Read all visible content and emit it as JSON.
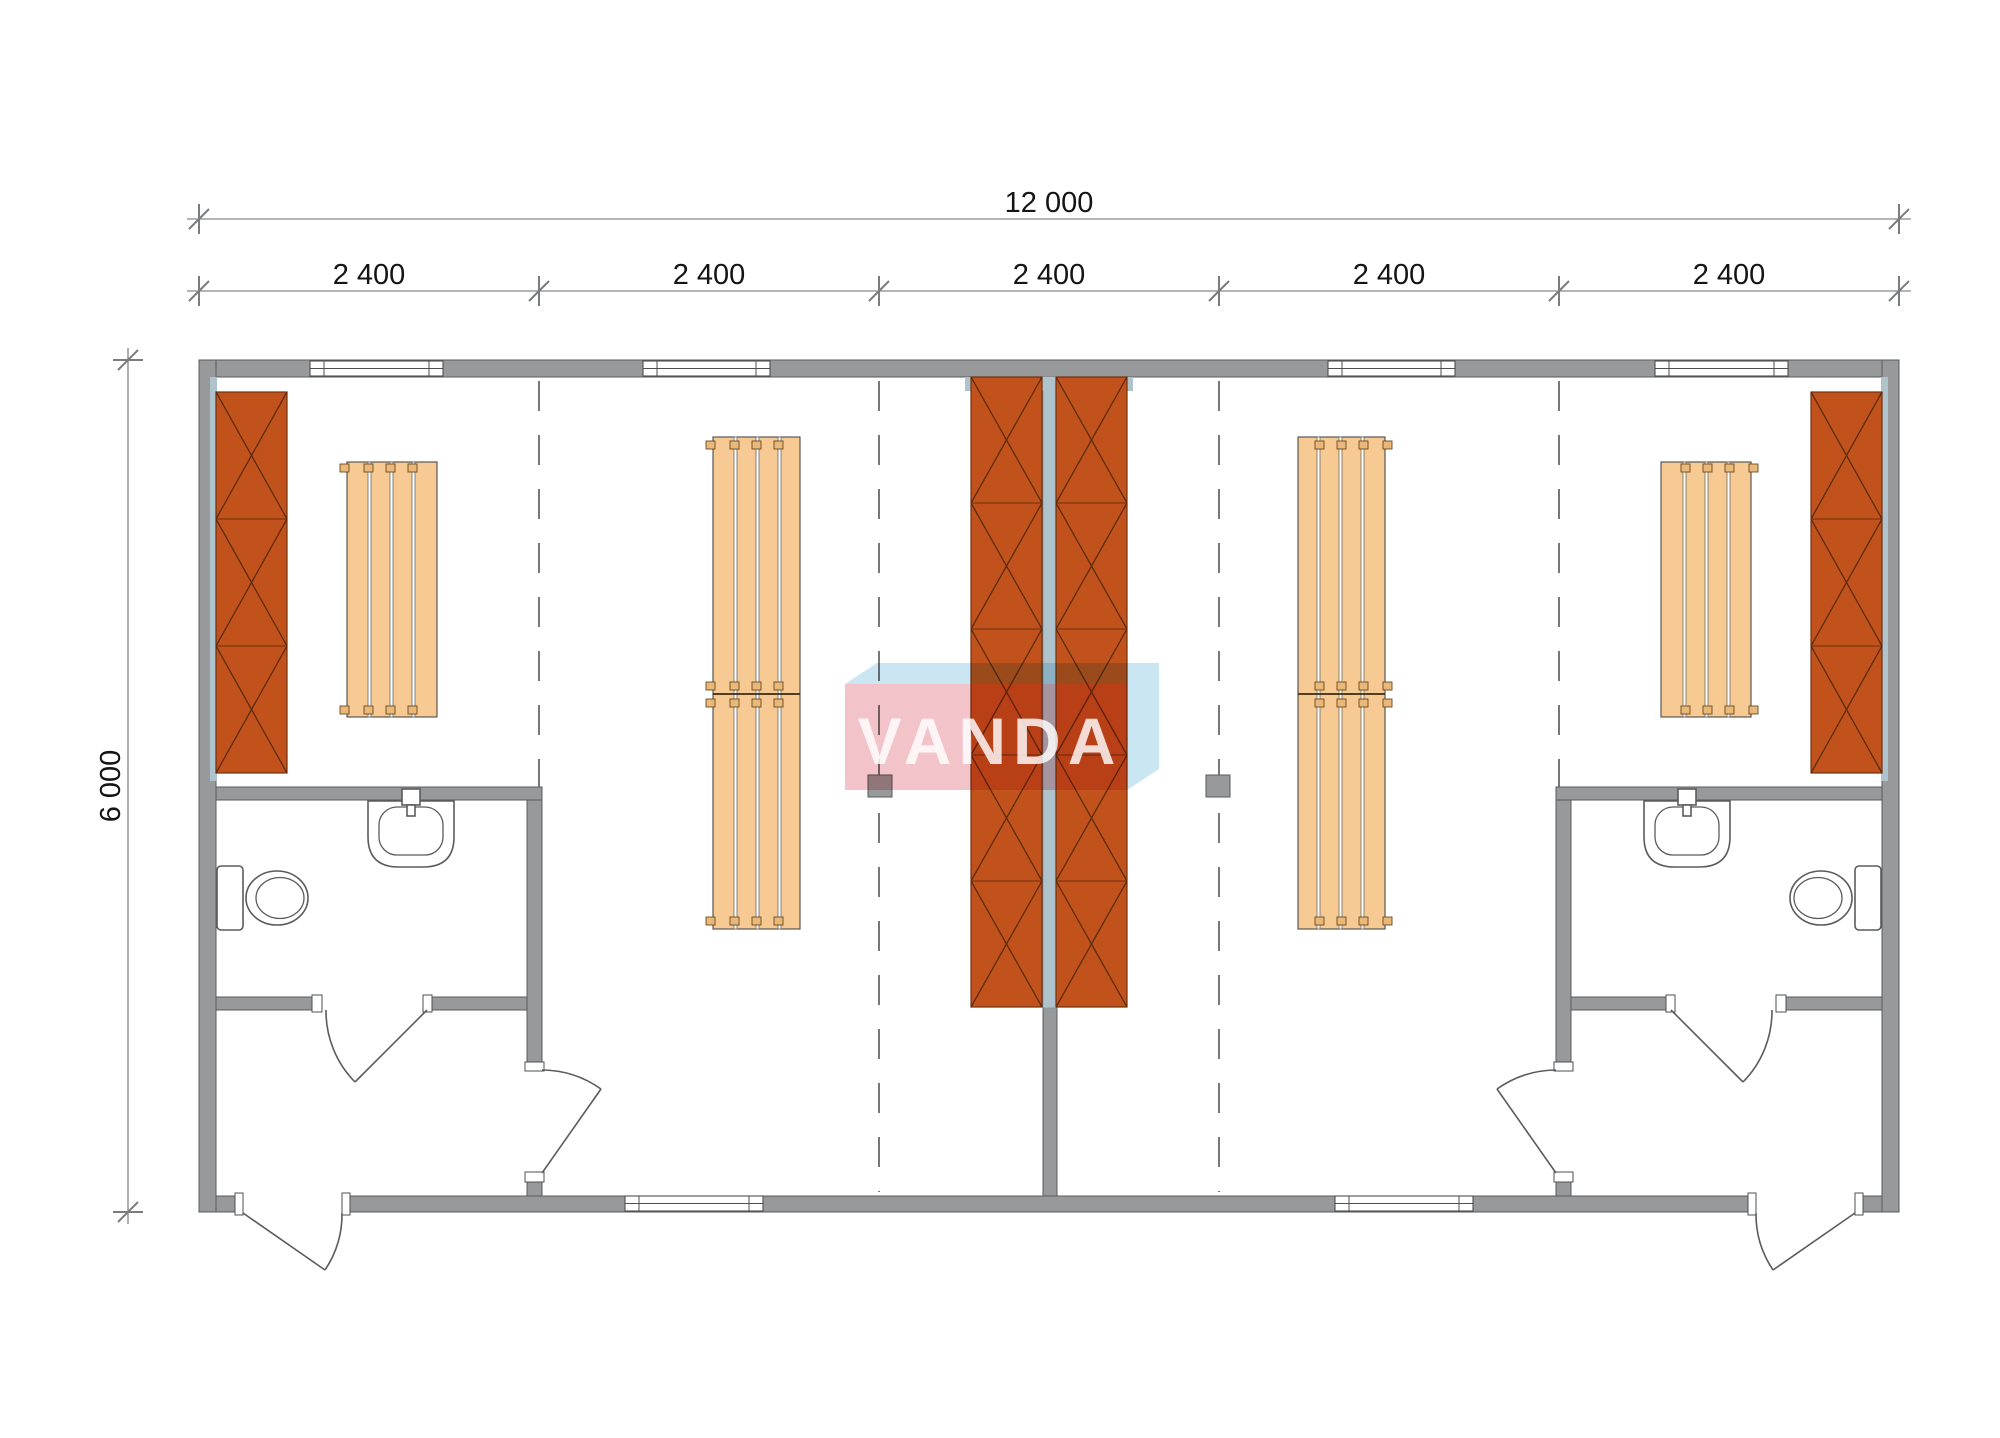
{
  "logo": {
    "text": "VANDA"
  },
  "dims": {
    "overall_width": "12 000",
    "overall_height": "6 000",
    "modules": [
      "2 400",
      "2 400",
      "2 400",
      "2 400",
      "2 400"
    ]
  },
  "colors": {
    "wall": "#98999b",
    "furniture_orange": "#c2521c",
    "bench_wood": "#f8ca93",
    "lining_blue": "#aec3cc",
    "logo_pink": "#f2c3c9",
    "logo_blue": "#cbe6f3"
  }
}
